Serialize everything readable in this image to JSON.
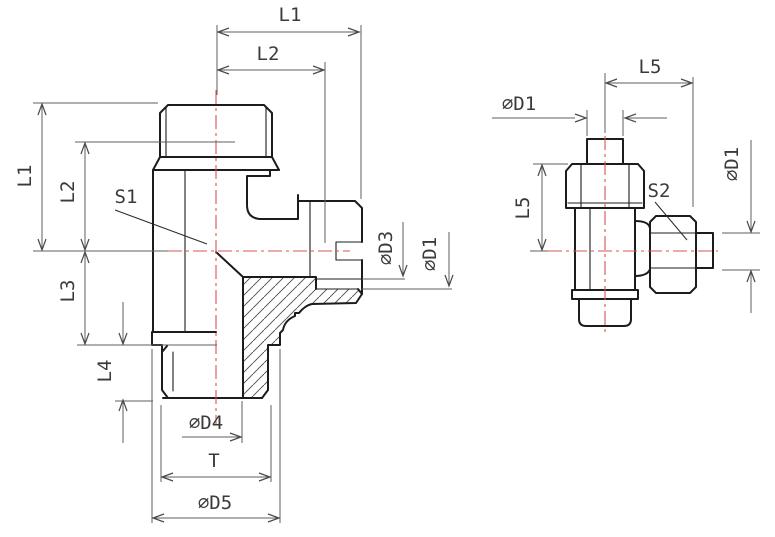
{
  "title": "Tee fitting technical drawing",
  "colors": {
    "background": "#ffffff",
    "outline": "#1c1c1c",
    "dimension_lines": "#5f5f5f",
    "centerline": "#d9534f",
    "label_text": "#3a3a3a"
  },
  "front_view": {
    "description": "sectioned front view of tee fitting",
    "labels": {
      "l1_top": "L1",
      "l2_top": "L2",
      "l1_left": "L1",
      "l2_left": "L2",
      "l3": "L3",
      "l4": "L4",
      "s1": "S1",
      "d3": "∅D3",
      "d1_side": "∅D1",
      "d4": "∅D4",
      "t": "T",
      "d5": "∅D5"
    }
  },
  "side_view": {
    "description": "side view of tee fitting with swivel nuts",
    "labels": {
      "l5_top": "L5",
      "d1_top": "∅D1",
      "l5_left": "L5",
      "s2": "S2",
      "d1_right": "∅D1"
    }
  }
}
